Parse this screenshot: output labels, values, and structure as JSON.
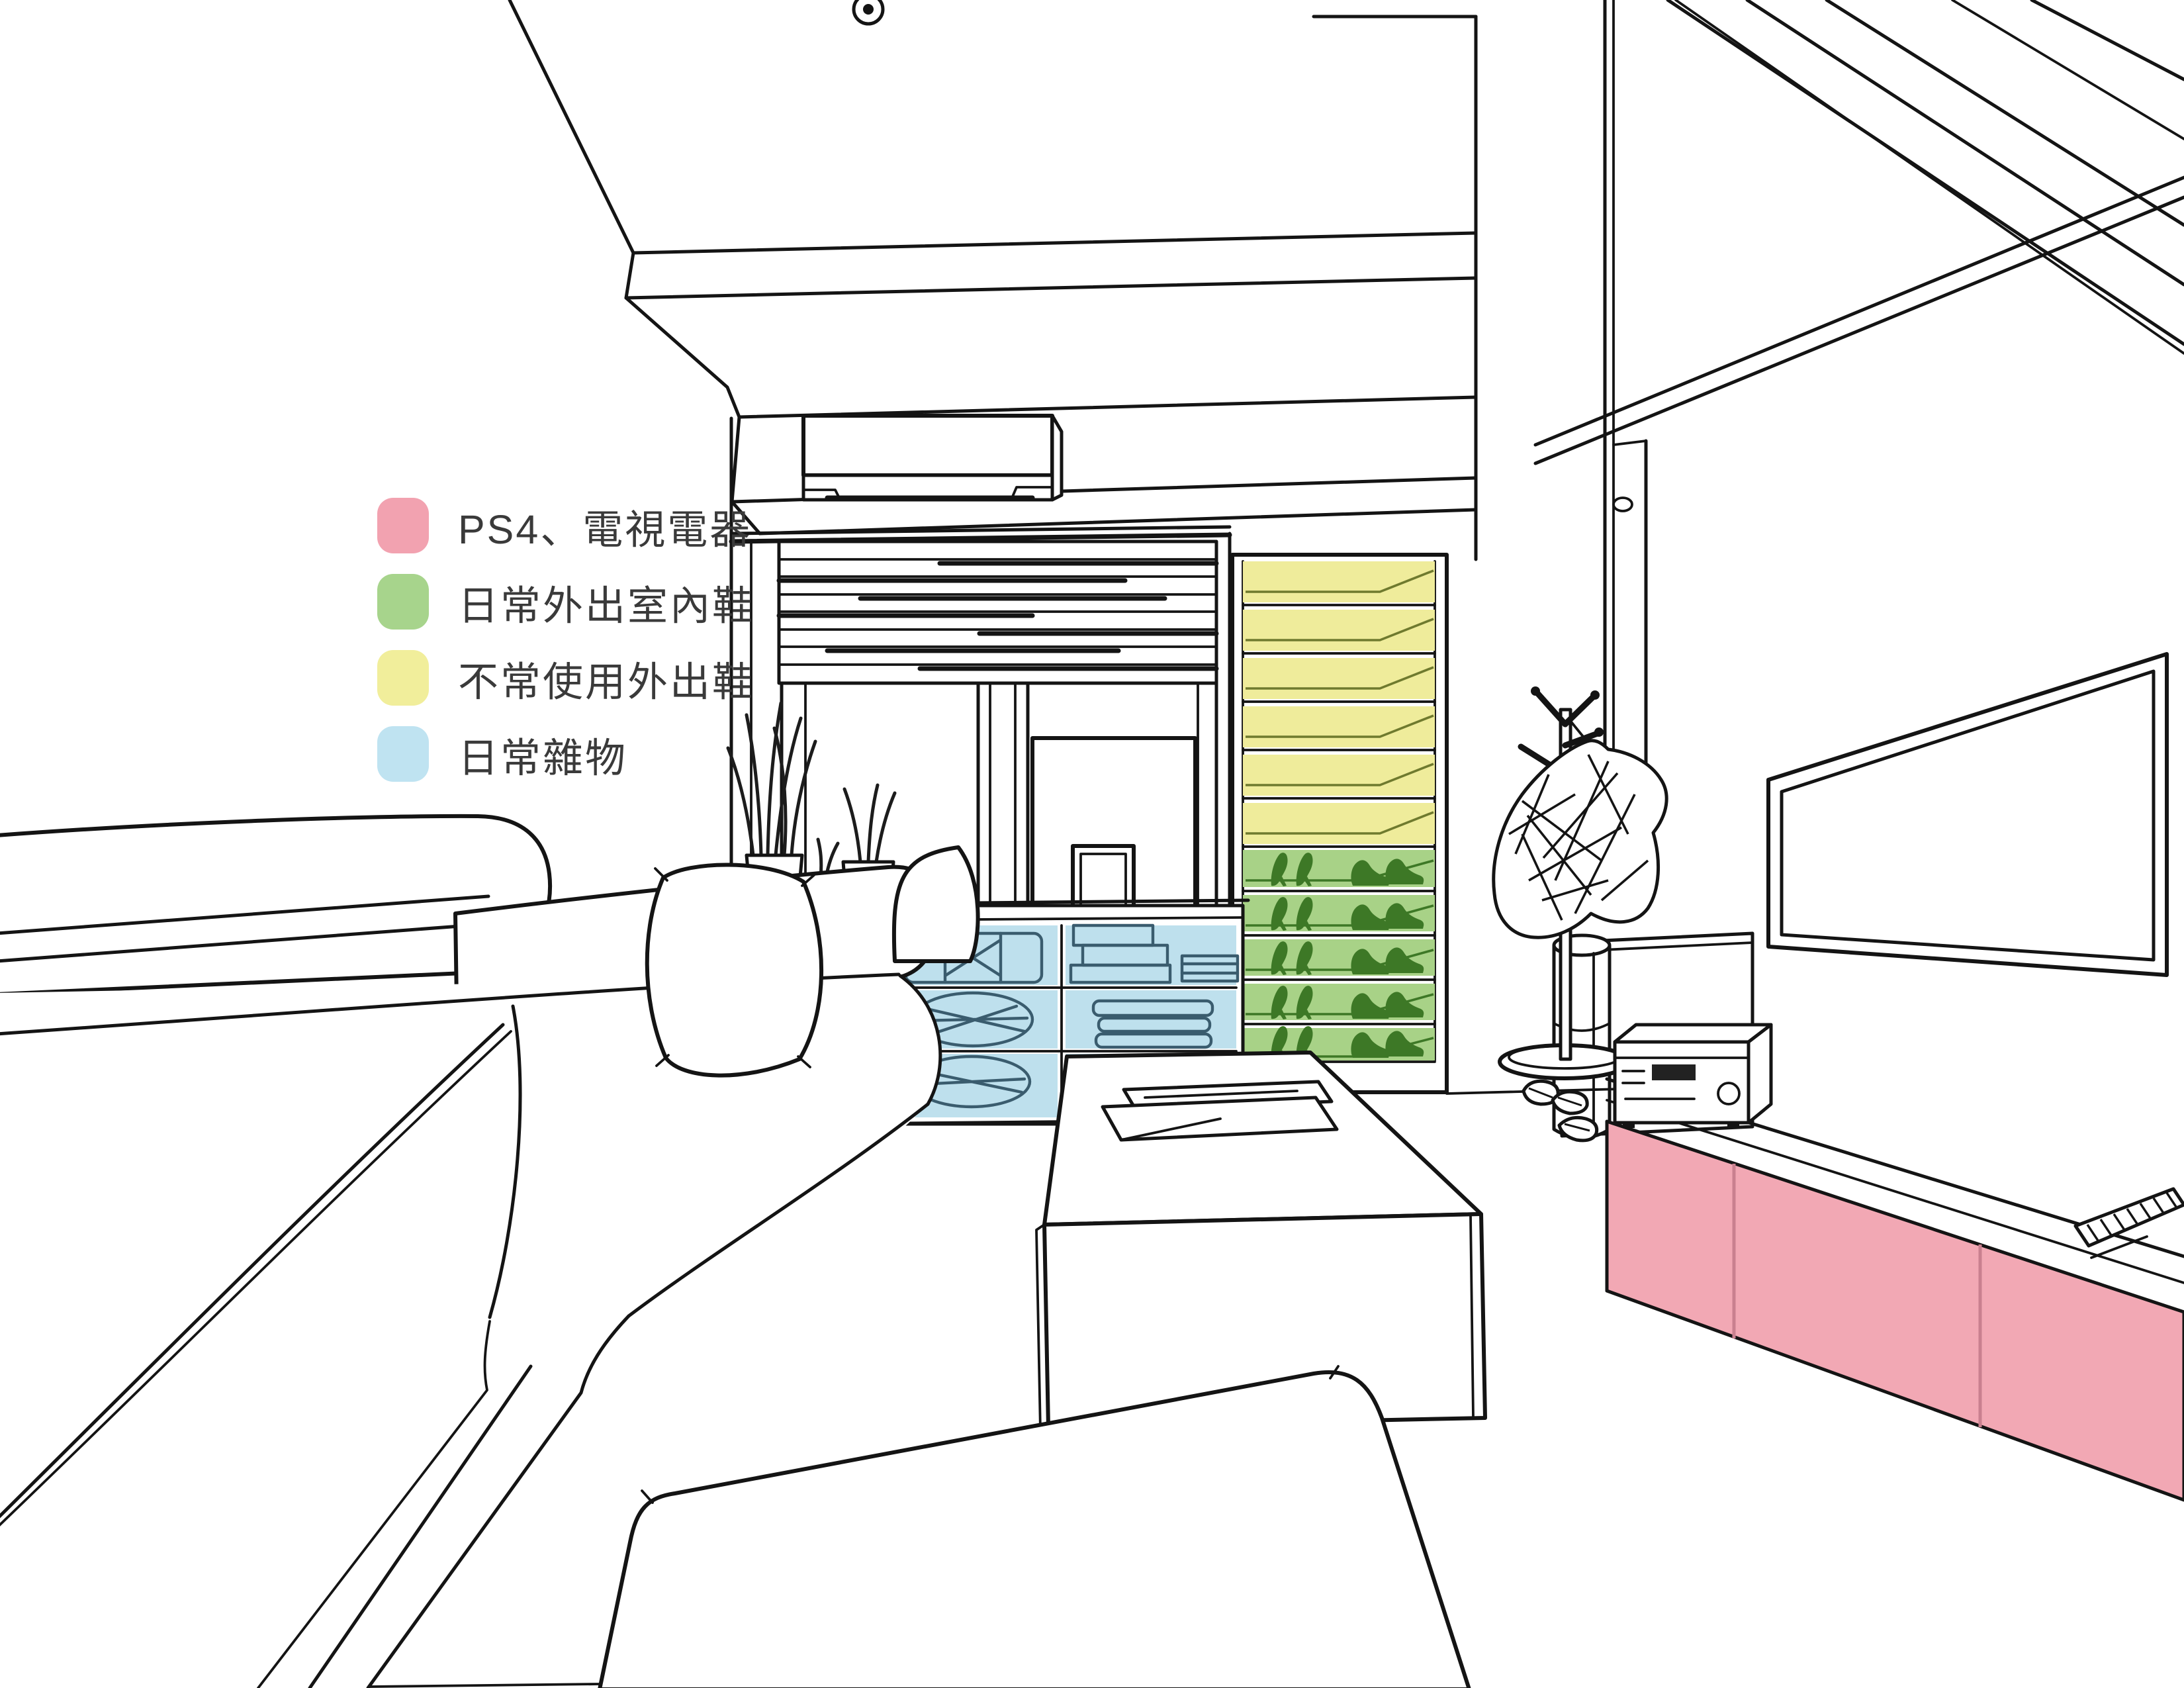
{
  "legend": {
    "items": [
      {
        "id": "ps4-tv",
        "label": "PS4、電視電器",
        "color": "#F2A2B0"
      },
      {
        "id": "daily-shoes",
        "label": "日常外出室內鞋",
        "color": "#A7D48C"
      },
      {
        "id": "rare-shoes",
        "label": "不常使用外出鞋",
        "color": "#F1EE9B"
      },
      {
        "id": "sundries",
        "label": "日常雜物",
        "color": "#BFE3F1"
      }
    ]
  },
  "zones": {
    "tv_console": "#F2A8B4",
    "rare_shoes": "#EFEC9B",
    "daily_shoes": "#A8D287",
    "sundries": "#BEE0ED",
    "daily_shoes_ink": "#3D7826",
    "rare_shoes_ink": "#6F7A2E",
    "sundries_ink": "#3A5C6E"
  }
}
